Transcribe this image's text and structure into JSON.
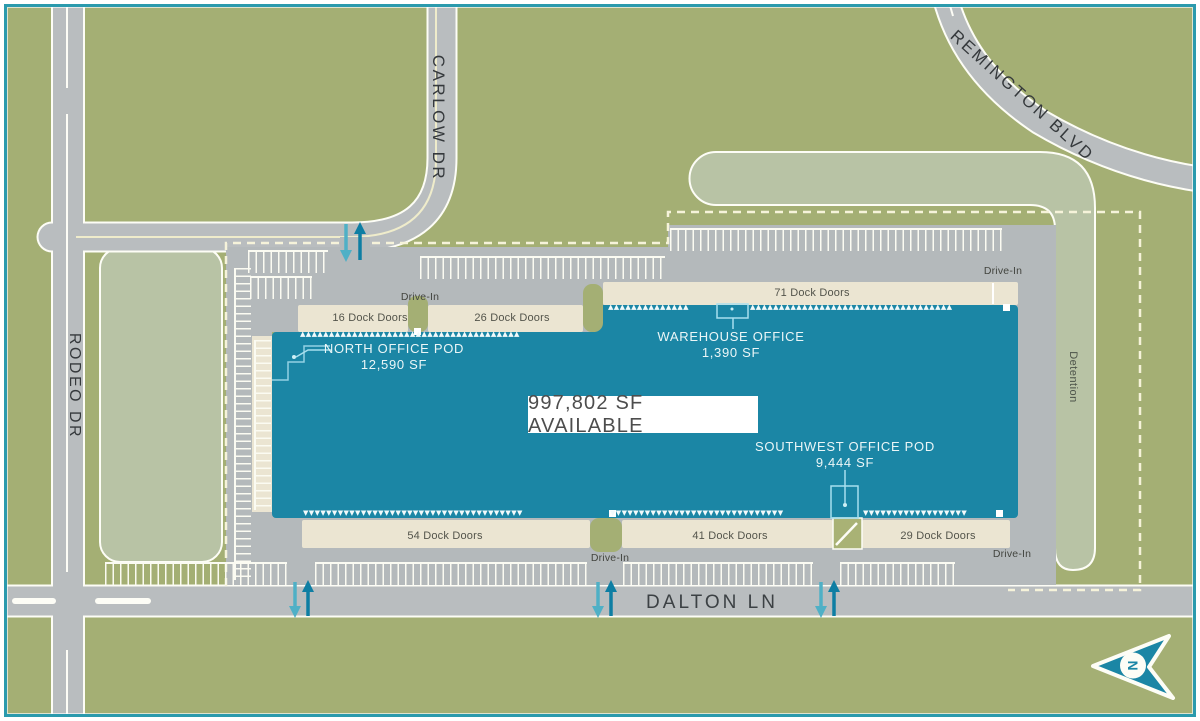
{
  "title_box": {
    "label": "997,802 SF AVAILABLE"
  },
  "roads": {
    "carlow": "CARLOW DR",
    "remington": "REMINGTON BLVD",
    "rodeo": "RODEO DR",
    "dalton": "DALTON LN"
  },
  "dock_doors": {
    "north_west": "16 Dock Doors",
    "north_center": "26 Dock Doors",
    "north_east": "71 Dock Doors",
    "south_west": "54 Dock Doors",
    "south_center": "41 Dock Doors",
    "south_east": "29 Dock Doors"
  },
  "offices": {
    "north": {
      "name": "NORTH OFFICE POD",
      "area": "12,590 SF"
    },
    "warehouse": {
      "name": "WAREHOUSE OFFICE",
      "area": "1,390 SF"
    },
    "southwest": {
      "name": "SOUTHWEST OFFICE POD",
      "area": "9,444 SF"
    }
  },
  "labels": {
    "drive_in": "Drive-In",
    "detention": "Detention",
    "compass": "N"
  },
  "colors": {
    "building_teal": "#1b86a5",
    "land_green": "#a4af74",
    "road_gray": "#b9bdbf",
    "apron_gray": "#b4b9bb",
    "dock_apron_cream": "#ebe5d2",
    "detention_sage": "#b8c3a5",
    "boundary_dash": "#f6f3da",
    "frame_teal": "#2b9aad",
    "arrow_light": "#4fb0c6",
    "arrow_dark": "#0e7ea3"
  }
}
